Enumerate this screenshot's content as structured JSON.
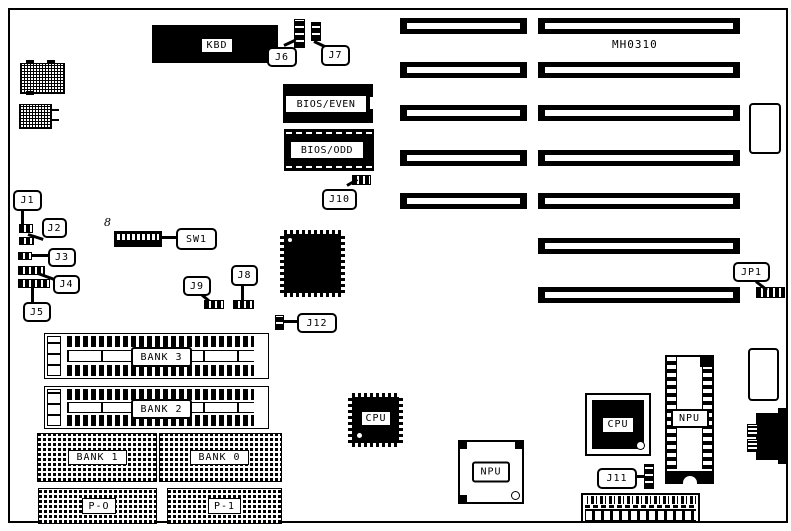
{
  "board": {
    "model": "MH0310"
  },
  "chips": {
    "kbd": "KBD",
    "bios_even": "BIOS/EVEN",
    "bios_odd": "BIOS/ODD",
    "cpu_qfp": "CPU",
    "cpu_socket": "CPU",
    "npu_socket": "NPU",
    "npu_dip": "NPU"
  },
  "memory": {
    "bank3": "BANK 3",
    "bank2": "BANK 2",
    "bank1": "BANK 1",
    "bank0": "BANK 0",
    "p0": "P-O",
    "p1": "P-1"
  },
  "jumpers": {
    "j1": "J1",
    "j2": "J2",
    "j3": "J3",
    "j4": "J4",
    "j5": "J5",
    "j6": "J6",
    "j7": "J7",
    "j8": "J8",
    "j9": "J9",
    "j10": "J10",
    "j11": "J11",
    "j12": "J12",
    "jp1": "JP1"
  },
  "switches": {
    "sw1": "SW1",
    "sw1_positions": "8"
  },
  "colors": {
    "ink": "#000000",
    "paper": "#ffffff"
  }
}
